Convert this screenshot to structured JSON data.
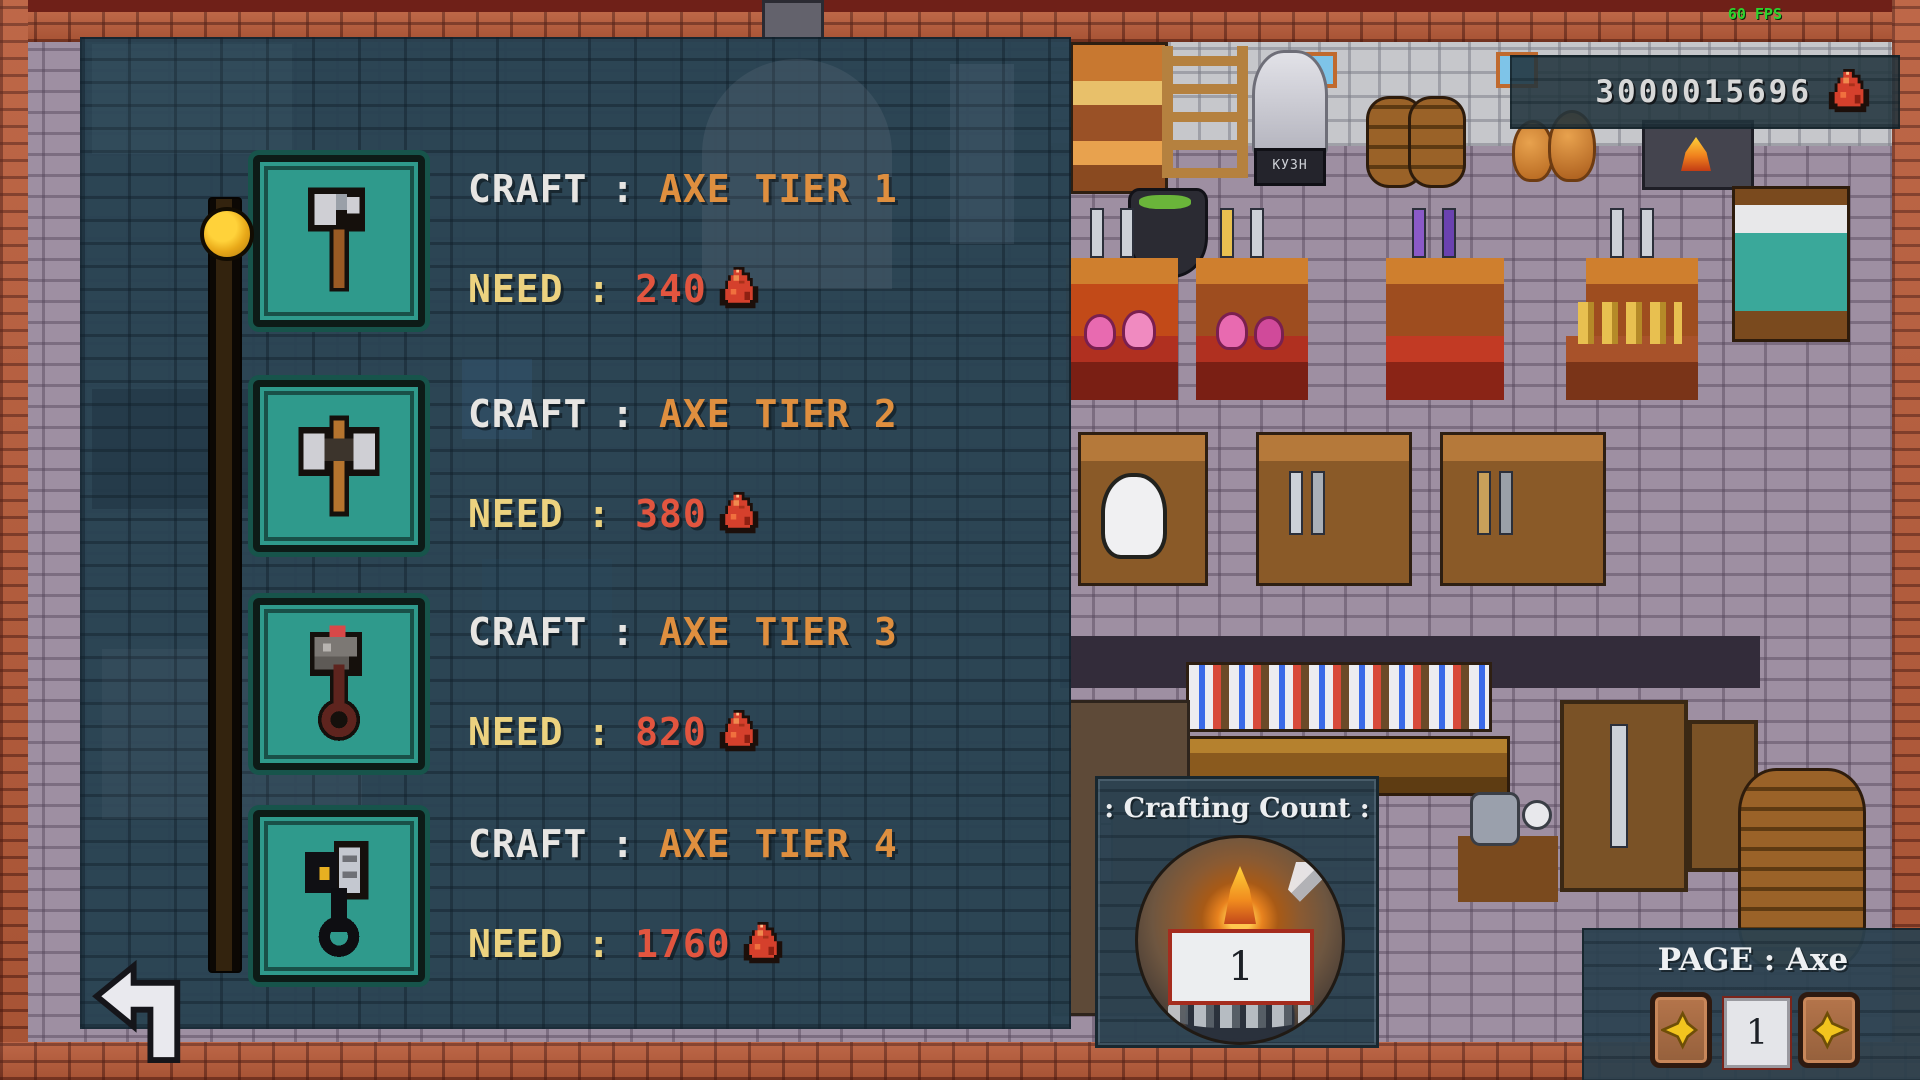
{
  "hud": {
    "fps_label": "60 FPS",
    "currency": {
      "amount": "3000015696",
      "icon": "red-ore-icon"
    }
  },
  "scene": {
    "sign_text": "КУЗН"
  },
  "craft_panel": {
    "items": [
      {
        "craft_prefix": "CRAFT : ",
        "item_name": "AXE TIER 1",
        "need_prefix": "NEED : ",
        "need_amount": "240",
        "icon": "axe-tier-1-icon"
      },
      {
        "craft_prefix": "CRAFT : ",
        "item_name": "AXE TIER 2",
        "need_prefix": "NEED : ",
        "need_amount": "380",
        "icon": "axe-tier-2-icon"
      },
      {
        "craft_prefix": "CRAFT : ",
        "item_name": "AXE TIER 3",
        "need_prefix": "NEED : ",
        "need_amount": "820",
        "icon": "axe-tier-3-icon"
      },
      {
        "craft_prefix": "CRAFT : ",
        "item_name": "AXE TIER 4",
        "need_prefix": "NEED : ",
        "need_amount": "1760",
        "icon": "axe-tier-4-icon"
      }
    ]
  },
  "crafting_count": {
    "title": ": Crafting Count :",
    "value": "1"
  },
  "pager": {
    "label": "PAGE : Axe",
    "page": "1"
  },
  "colors": {
    "accent_orange": "#df8f3f",
    "need_yellow": "#ecd27f",
    "need_red": "#e2553f",
    "fps_green": "#2ed42e",
    "tile_teal": "#2f9a8c"
  }
}
